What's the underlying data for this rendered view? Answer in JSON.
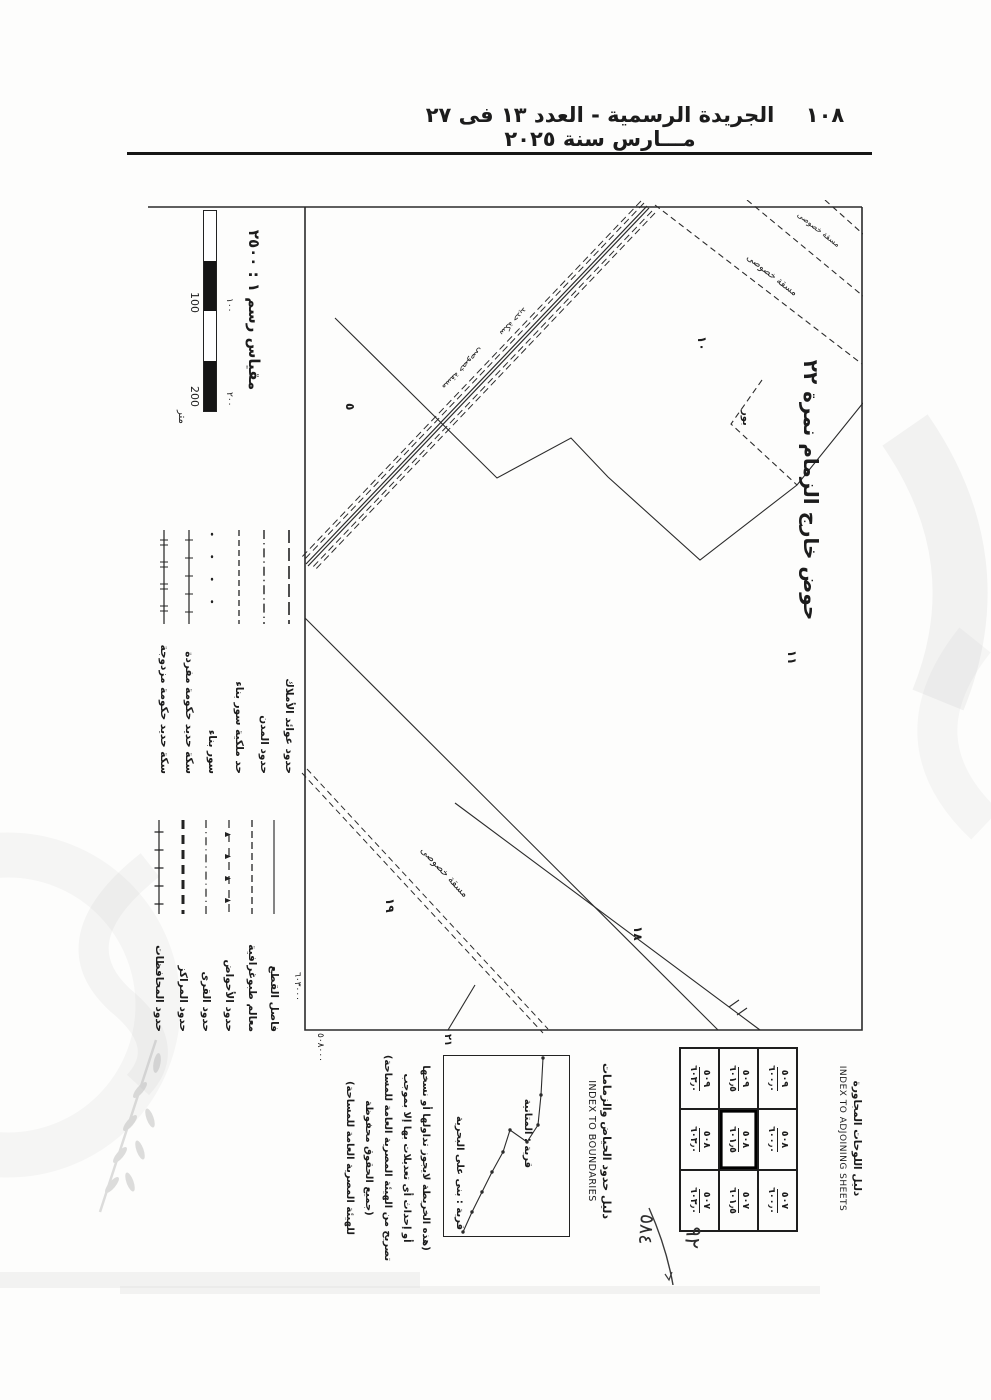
{
  "header": {
    "title": "الجريدة الرسمية - العدد ١٣ فى ٢٧ مـــارس سنة ٢٠٢٥",
    "page_number": "١٠٨"
  },
  "sheet": {
    "scale": {
      "title": "مقياس رسم ١ : ٢٥٠٠",
      "ar100": "١٠٠",
      "ar200": "٢٠٠",
      "lat100": "100",
      "lat200": "200",
      "unit": "متر"
    },
    "legend": {
      "group1": [
        {
          "label": "حدود عوائد الأملاك",
          "style": "long-dash"
        },
        {
          "label": "حدود المدن",
          "style": "dash-dot"
        },
        {
          "label": "حد ملكية سور بناء",
          "style": "dashed"
        },
        {
          "label": "سور بناء",
          "style": "dotted"
        },
        {
          "label": "سكة حديد حكومة مفردة",
          "style": "rail-single"
        },
        {
          "label": "سكة حديد حكومة مزدوجة",
          "style": "rail-double"
        }
      ],
      "group2": [
        {
          "label": "فاصل القطع",
          "style": "solid"
        },
        {
          "label": "معالم طبوغرافية",
          "style": "dashed"
        },
        {
          "label": "حدود الأحواض",
          "style": "dash-triangle"
        },
        {
          "label": "حدود القرى",
          "style": "dash-dot"
        },
        {
          "label": "حدود المراكز",
          "style": "heavy-dash"
        },
        {
          "label": "حدود المحافظات",
          "style": "tick-line"
        }
      ]
    },
    "map": {
      "basin_label": "حوض خارج الزمام نمرة ٢٢",
      "plot5": "٥",
      "plot10": "١٠",
      "plot11": "١١",
      "plot18": "١٨",
      "plot19": "١٩",
      "land": "بور",
      "masqa": "مسقة خصوصى",
      "railway": "سكة حديد",
      "edge21": "٢١",
      "coord_n": "٦٠٣٠٠٠",
      "coord_e": "٥٠٨٠٠٠"
    },
    "adjoining": {
      "title_ar": "دليل اللوحات المجاورة",
      "title_en": "INDEX TO ADJOINING SHEETS",
      "cells": [
        {
          "top": "٥٠٩",
          "bottom": "٦٠٠٫٠"
        },
        {
          "top": "٥٠٨",
          "bottom": "٦٠٠٫٠"
        },
        {
          "top": "٥٠٧",
          "bottom": "٦٠٠٫٠"
        },
        {
          "top": "٥٠٩",
          "bottom": "٦٠١٫٥"
        },
        {
          "top": "٥٠٨",
          "bottom": "٦٠١٫٥"
        },
        {
          "top": "٥٠٧",
          "bottom": "٦٠١٫٥"
        },
        {
          "top": "٥٠٩",
          "bottom": "٦٠٣٫٠"
        },
        {
          "top": "٥٠٨",
          "bottom": "٦٠٣٫٠"
        },
        {
          "top": "٥٠٧",
          "bottom": "٦٠٣٫٠"
        }
      ],
      "current_cell_index": 4
    },
    "boundaries": {
      "title_ar": "دليل حدود الحياض والزمامات",
      "title_en": "INDEX TO BOUNDARIES",
      "village_top": "قرية : المتانية",
      "village_bottom": "قرية : بنى على البحرية"
    },
    "copyright": {
      "line1": "(هذه الخريطة لايجوز تداولها أو نسخها",
      "line2": "أو إحداث أى تعديلات بها إلا بموجب",
      "line3": "تصريح من الهيئة المصرية العامة للمساحة)",
      "line4": "(جميع الحقوق محفوظة",
      "line5": "للهيئة المصرية العامة للمساحة)"
    },
    "handwritten": {
      "num_top": "٩٢",
      "num_bottom": "٥٨٤"
    }
  },
  "colors": {
    "ink": "#1c1c1c",
    "line": "#2b2b2b",
    "watermark": "#bdbdbd"
  }
}
